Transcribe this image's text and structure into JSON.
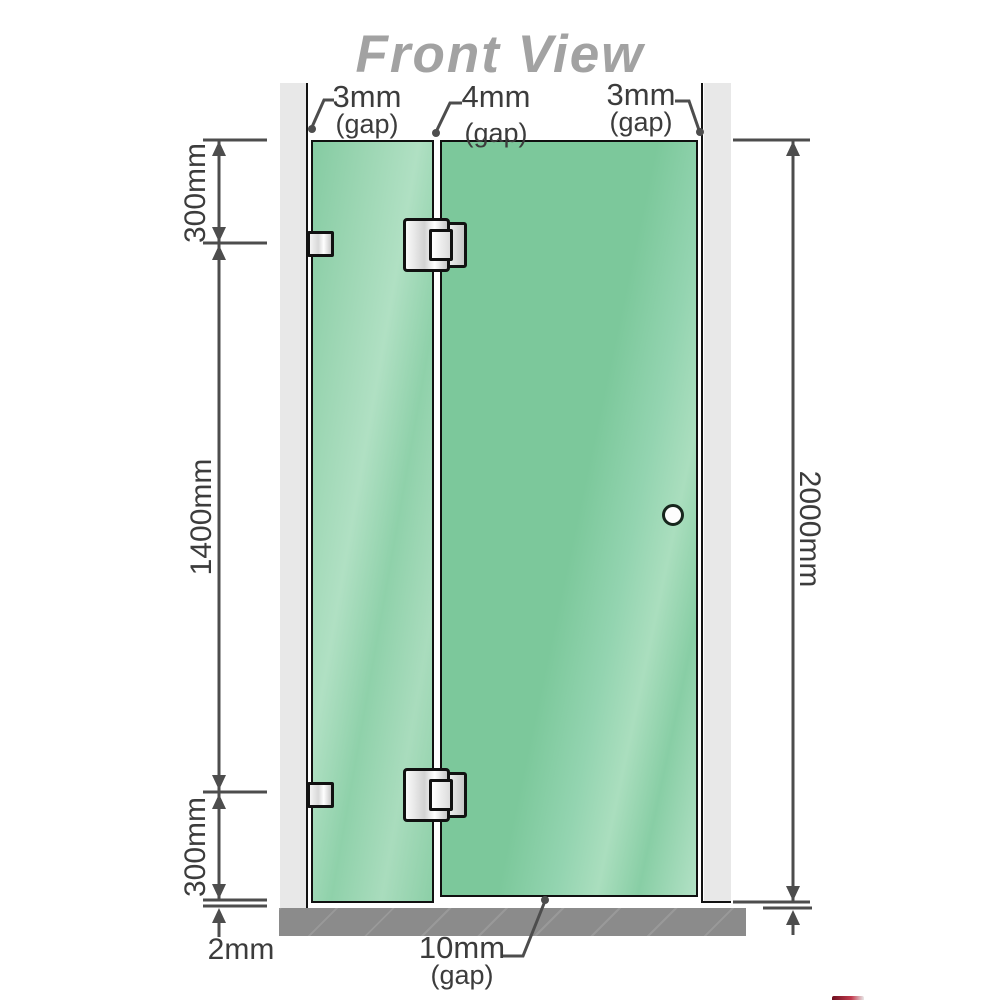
{
  "diagram": {
    "title": "Front View",
    "annotations": {
      "top_gaps": [
        {
          "value": "3mm",
          "suffix": "(gap)"
        },
        {
          "value": "4mm",
          "suffix": "(gap)"
        },
        {
          "value": "3mm",
          "suffix": "(gap)"
        }
      ],
      "left_dimensions": {
        "top": "300mm",
        "middle": "1400mm",
        "bottom": "300mm"
      },
      "right_dimension": "2000mm",
      "floor_gap": "2mm",
      "bottom_gap": {
        "value": "10mm",
        "suffix": "(gap)"
      }
    },
    "components": [
      "left-wall",
      "right-wall",
      "fixed-glass-panel",
      "door-glass-panel",
      "wall-bracket-top",
      "wall-bracket-bottom",
      "glass-hinge-top",
      "glass-hinge-bottom",
      "door-knob",
      "floor-base"
    ],
    "colors": {
      "glass": "#7cc89b",
      "glass_highlight": "#aadebe",
      "wall": "#e8e8e8",
      "floor": "#8b8b8b",
      "outline": "#111111",
      "dimension_lines": "#4d4d4d",
      "title_text": "#a2a2a2"
    }
  }
}
